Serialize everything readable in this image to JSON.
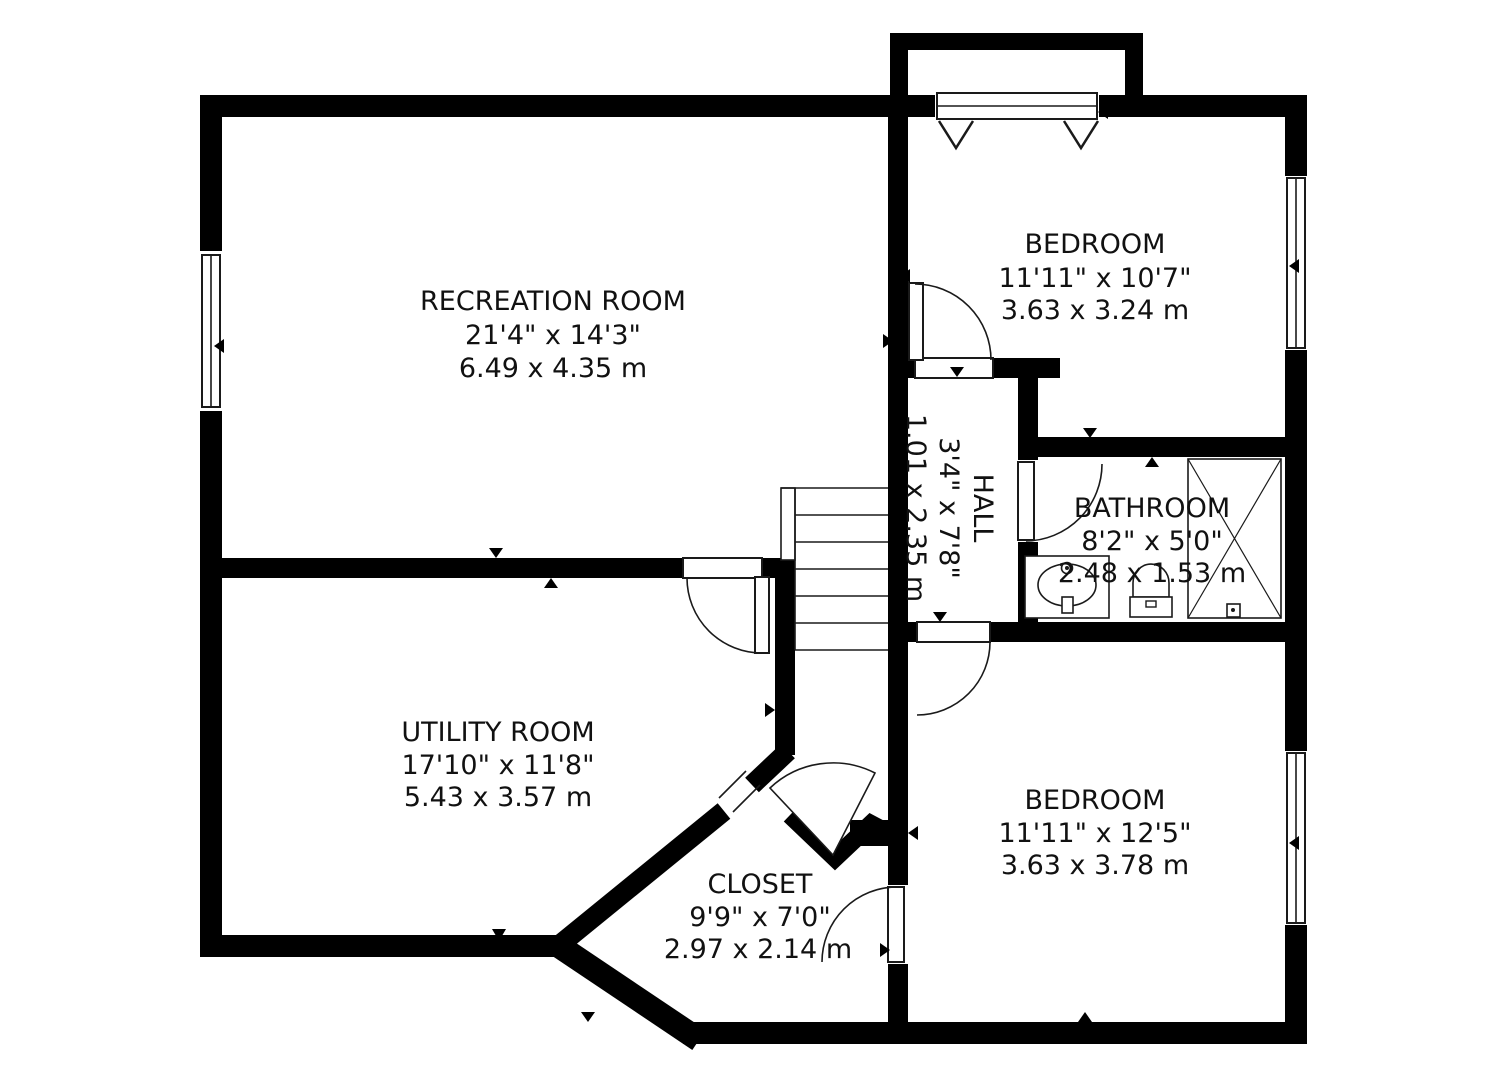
{
  "floorplan": {
    "colors": {
      "wall": "#000000",
      "background": "#ffffff",
      "text": "#111111"
    },
    "icons": [
      "window",
      "door-swing",
      "stairs",
      "sink",
      "toilet",
      "shower-crossbox",
      "wall-marker"
    ],
    "rooms": [
      {
        "id": "recreation-room",
        "name": "RECREATION ROOM",
        "imperial": "21'4\" x 14'3\"",
        "metric": "6.49 x 4.35 m"
      },
      {
        "id": "bedroom-top",
        "name": "BEDROOM",
        "imperial": "11'11\" x 10'7\"",
        "metric": "3.63 x 3.24 m"
      },
      {
        "id": "hall",
        "name": "HALL",
        "imperial": "3'4\" x 7'8\"",
        "metric": "1.01 x 2.35 m"
      },
      {
        "id": "bathroom",
        "name": "BATHROOM",
        "imperial": "8'2\" x 5'0\"",
        "metric": "2.48 x 1.53 m"
      },
      {
        "id": "utility-room",
        "name": "UTILITY ROOM",
        "imperial": "17'10\" x 11'8\"",
        "metric": "5.43 x 3.57 m"
      },
      {
        "id": "closet",
        "name": "CLOSET",
        "imperial": "9'9\" x 7'0\"",
        "metric": "2.97 x 2.14 m"
      },
      {
        "id": "bedroom-bottom",
        "name": "BEDROOM",
        "imperial": "11'11\" x 12'5\"",
        "metric": "3.63 x 3.78 m"
      }
    ]
  }
}
